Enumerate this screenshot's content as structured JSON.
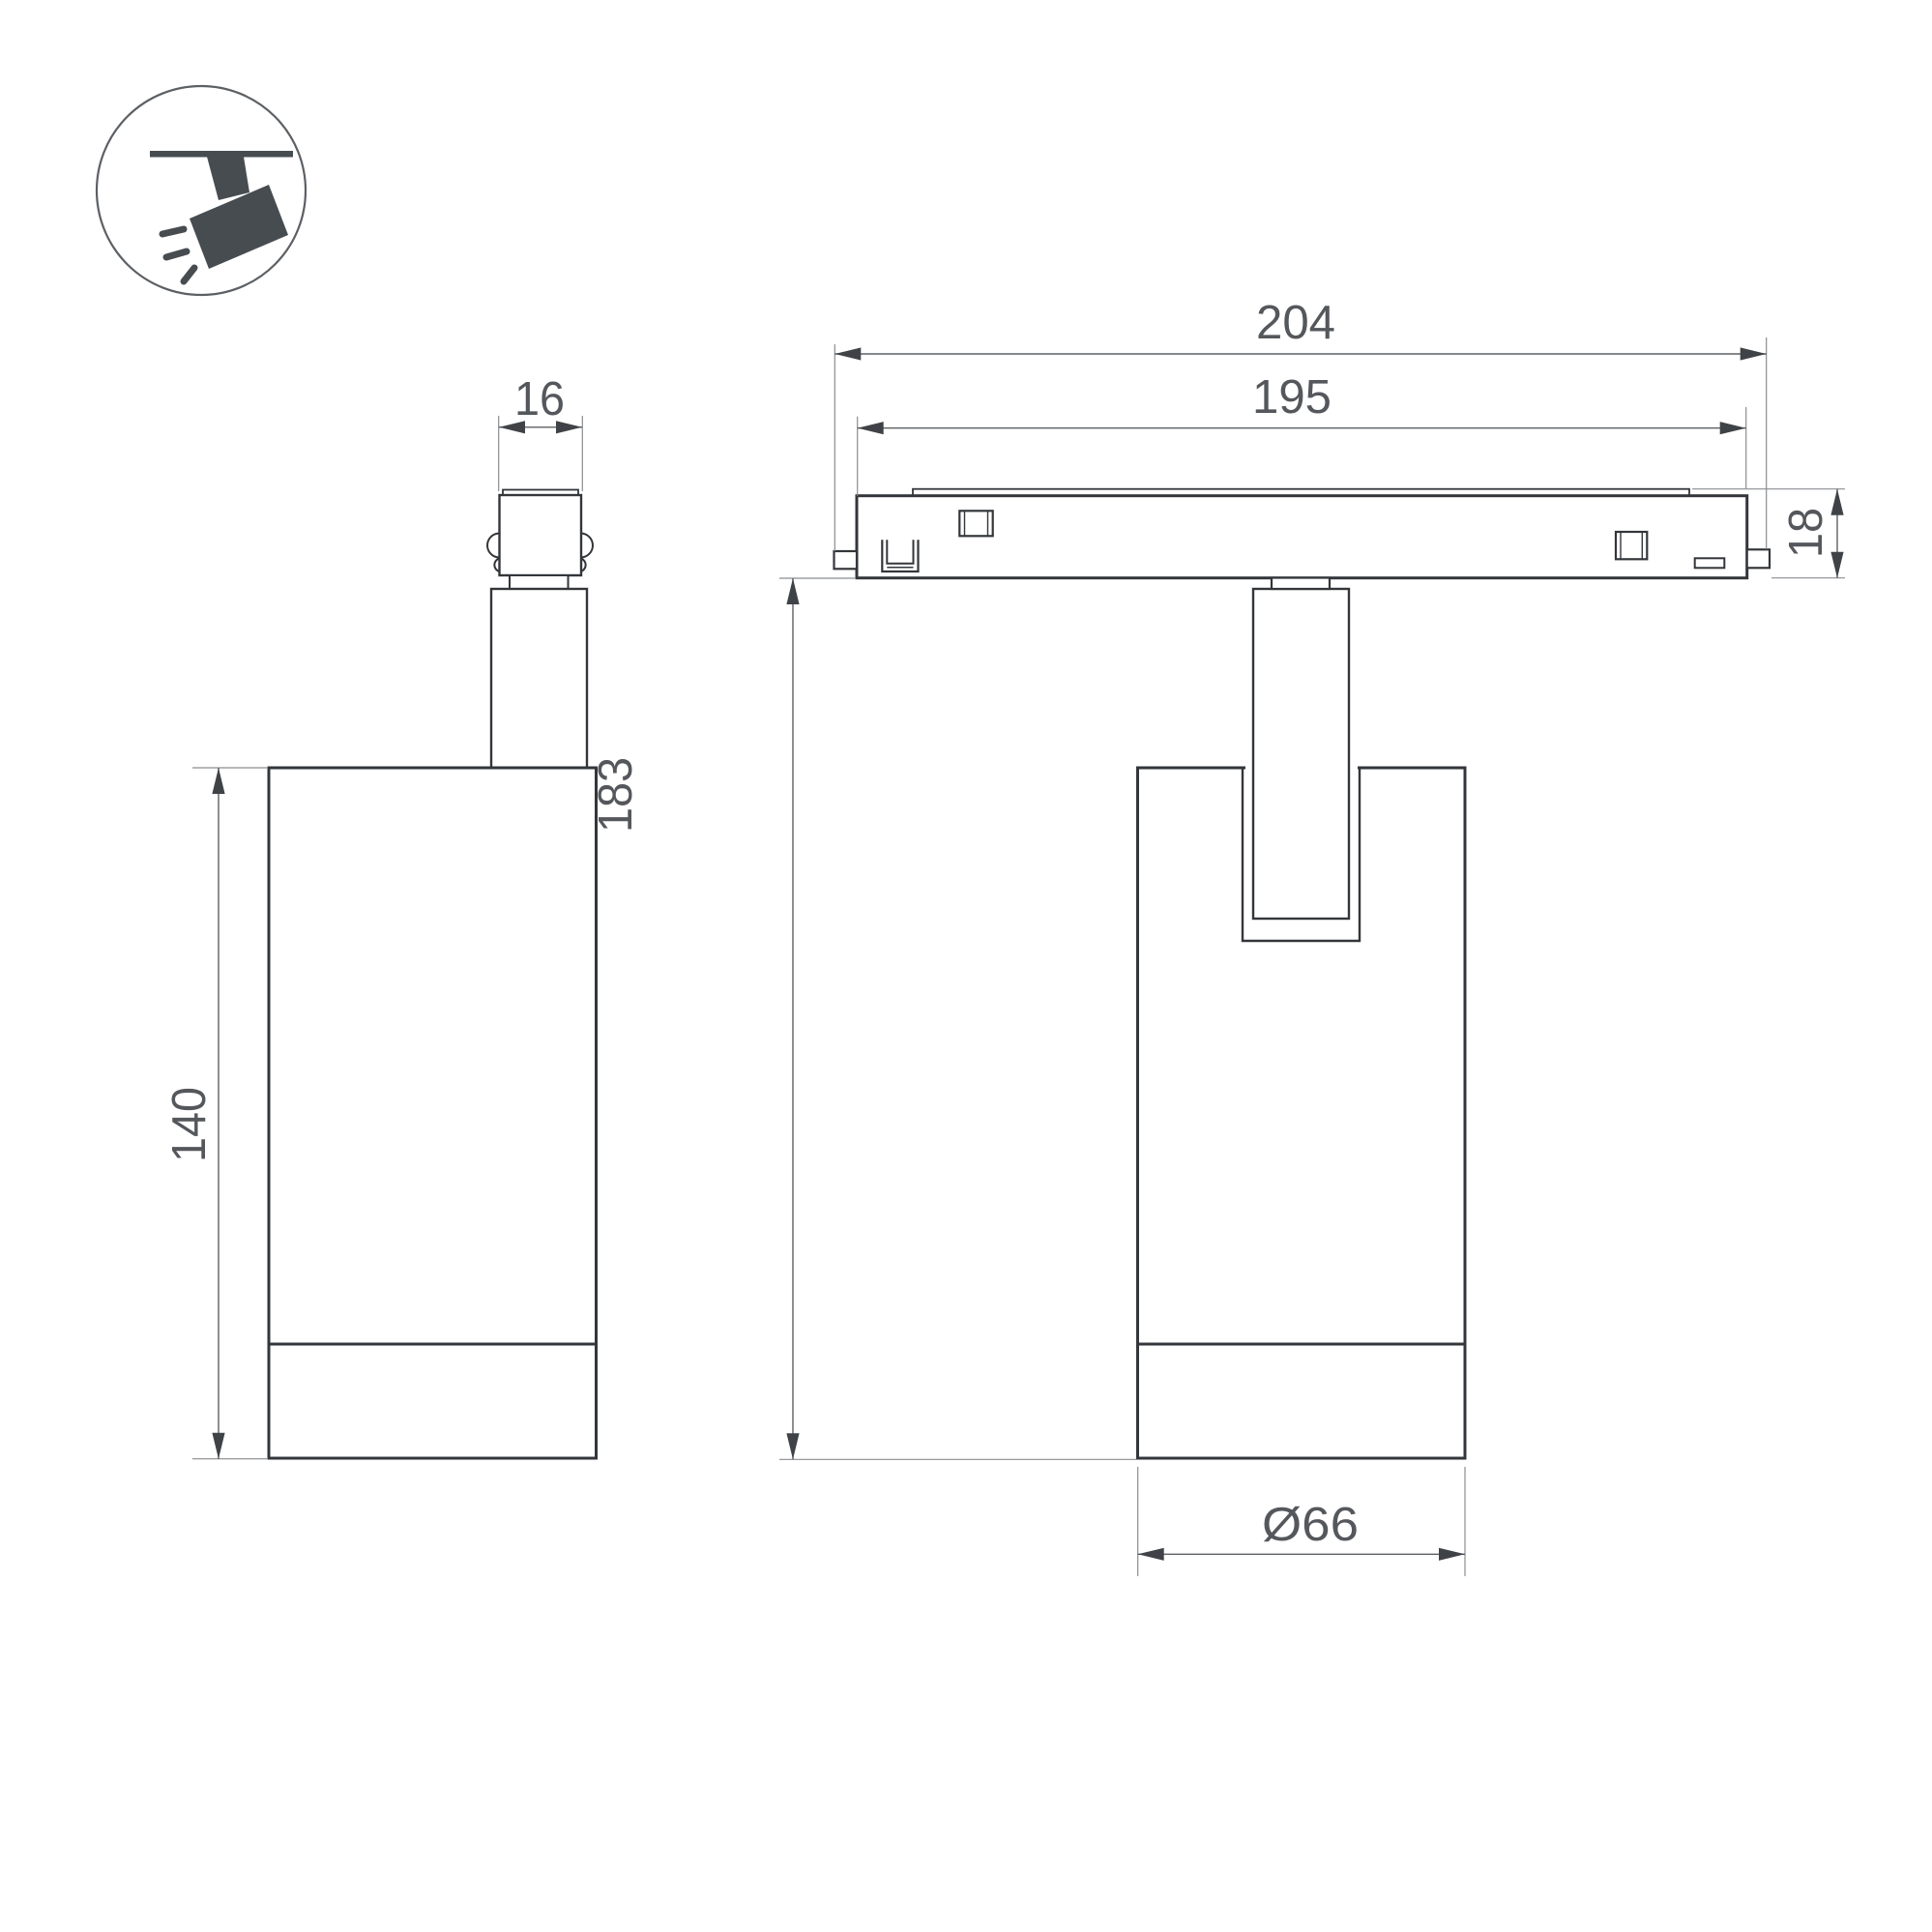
{
  "drawing": {
    "type": "technical-dimension-drawing",
    "product": "magnetic-track-spotlight",
    "icon": "track-spotlight-icon",
    "dimensions": {
      "adapter_width": "16",
      "body_height": "140",
      "track_overall_length": "204",
      "track_body_length": "195",
      "track_height": "18",
      "overall_height": "183",
      "body_diameter": "Ø66"
    },
    "colors": {
      "object_line": "#33363a",
      "dimension_line": "#5d6165",
      "dimension_text": "#54575b",
      "icon": "#474c51",
      "background": "#ffffff"
    }
  }
}
